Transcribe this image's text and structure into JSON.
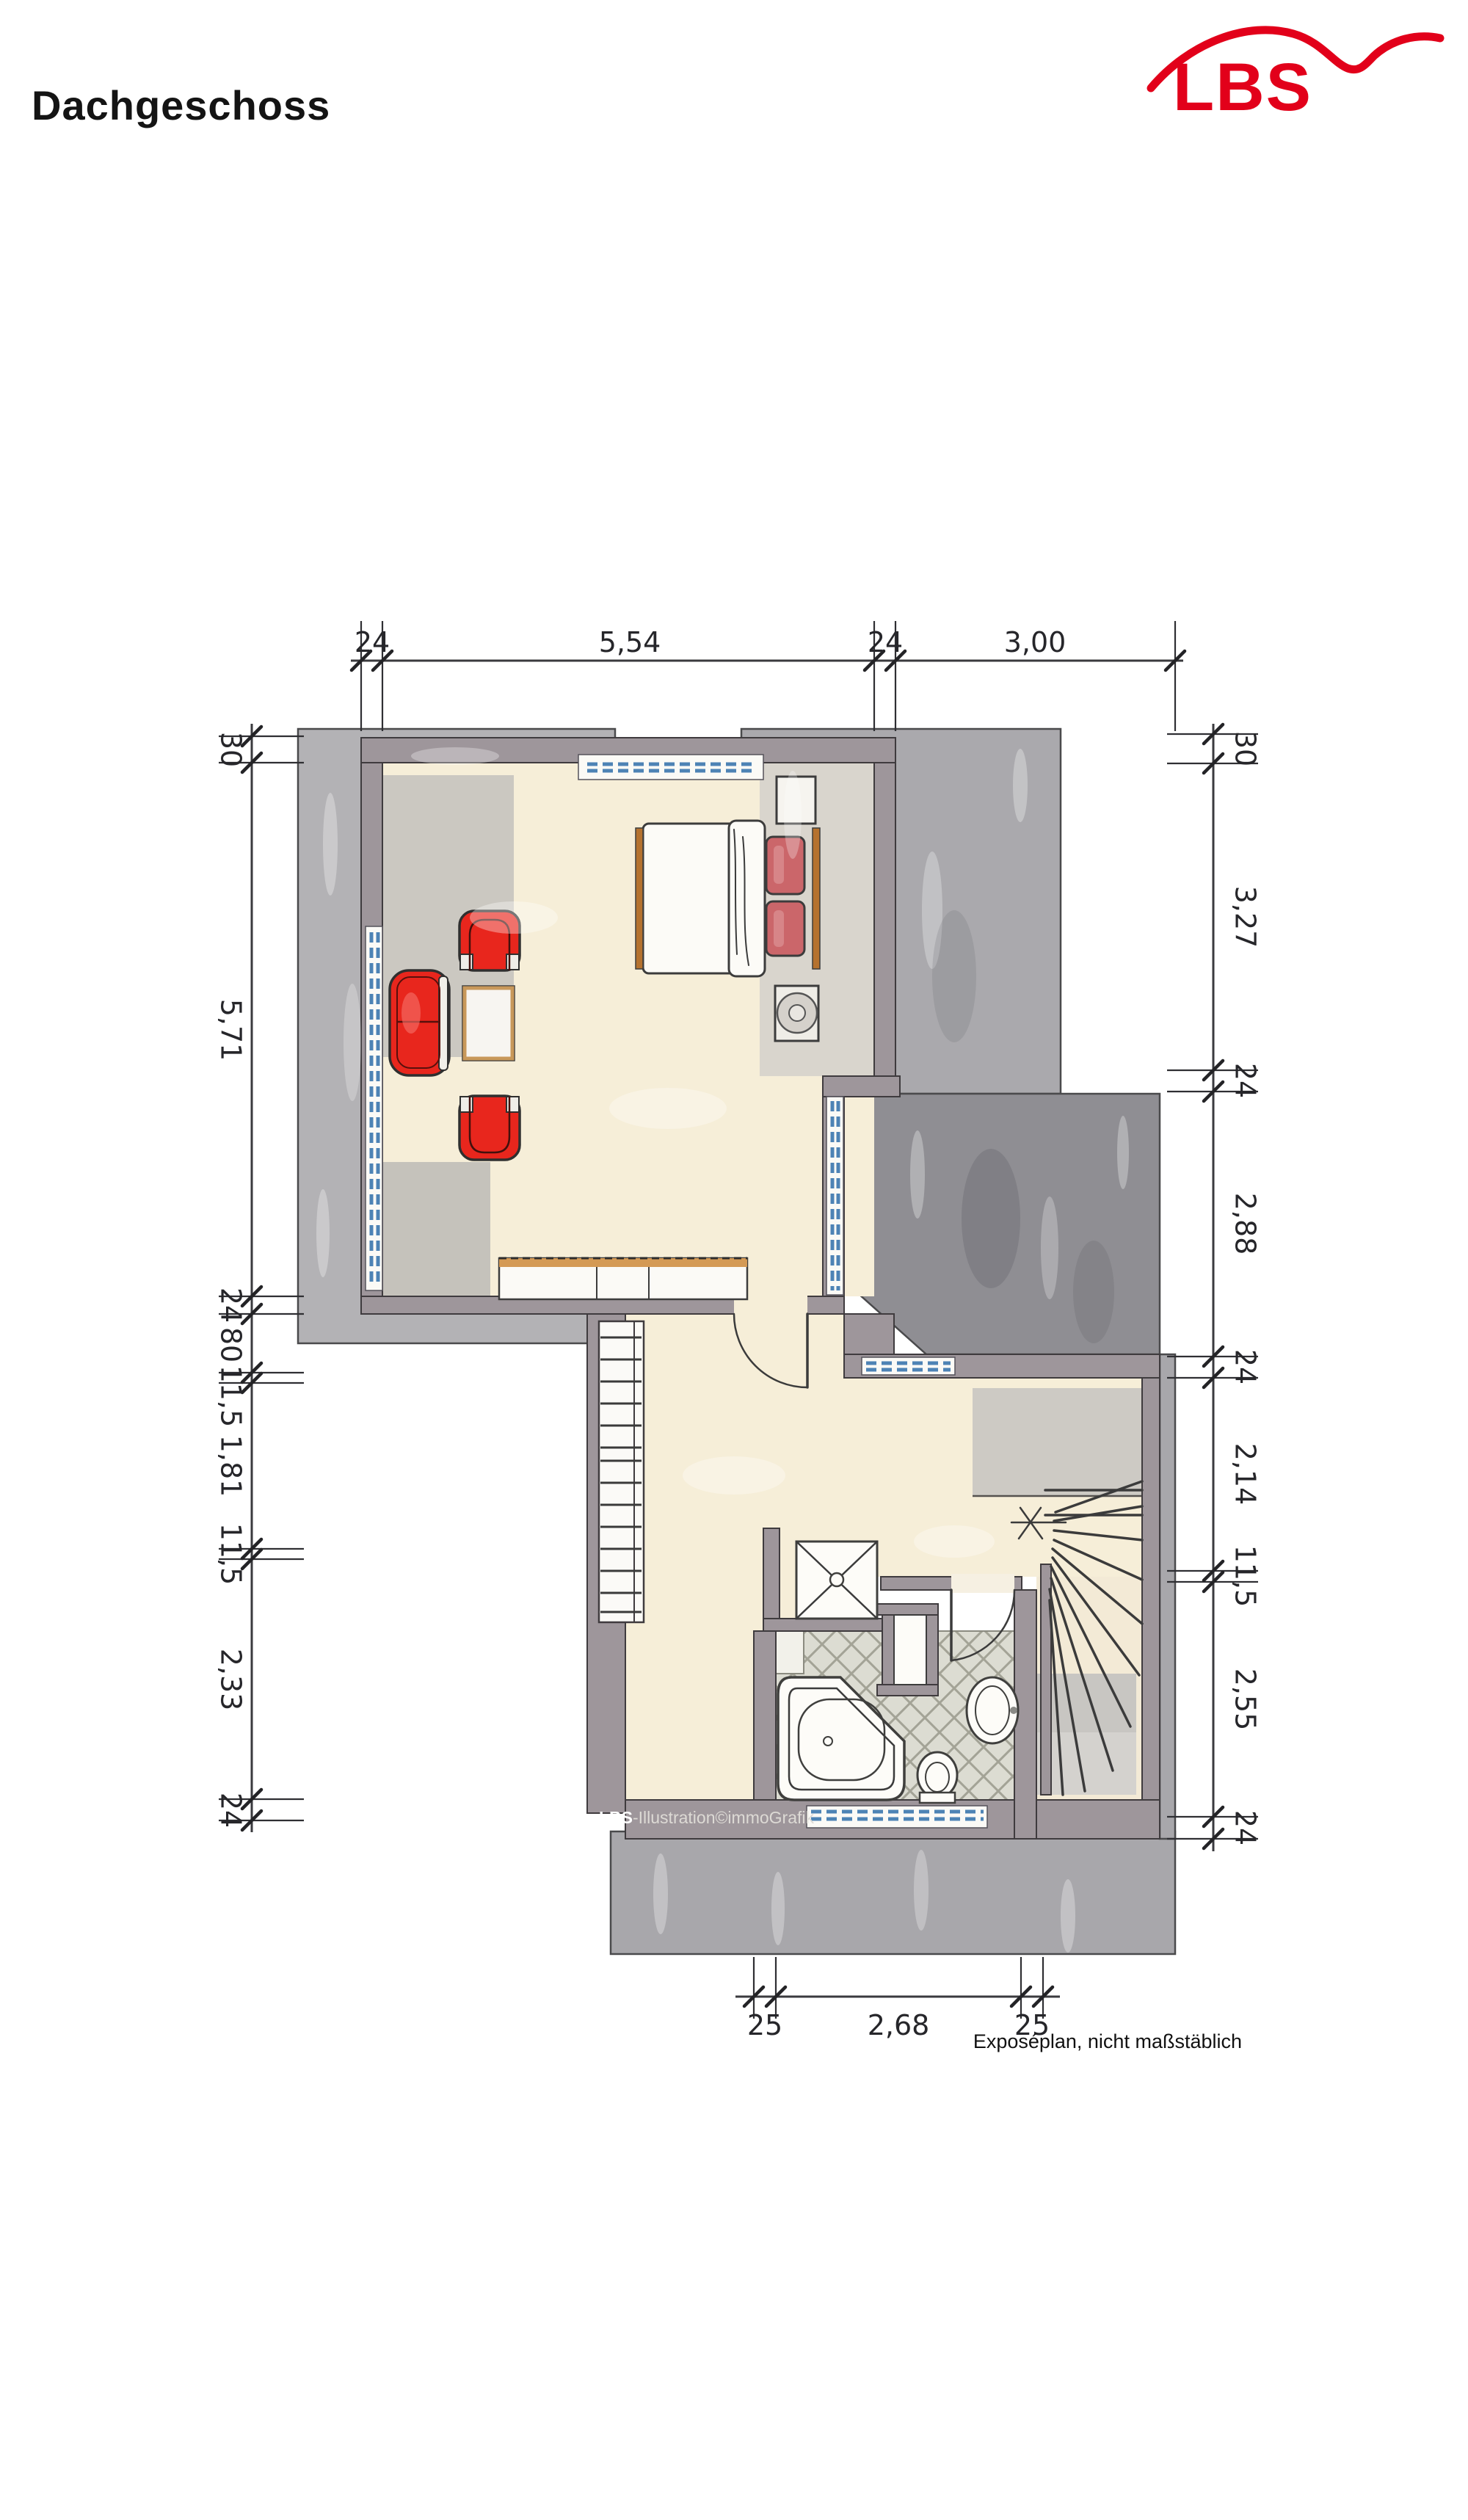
{
  "header": {
    "title": "Dachgeschoss"
  },
  "brand": {
    "name": "LBS",
    "color": "#e2001a"
  },
  "plan": {
    "watermark_bold": "LBS",
    "watermark_rest": "-Illustration©immoGrafik"
  },
  "footer": {
    "note": "Exposéplan, nicht maßstäblich"
  },
  "dimensions": {
    "top": [
      "24",
      "5,54",
      "24",
      "3,00"
    ],
    "left": [
      "30",
      "5,71",
      "24",
      "80",
      "11,5",
      "1,81",
      "11,5",
      "2,33",
      "24"
    ],
    "right": [
      "30",
      "3,27",
      "24",
      "2,88",
      "24",
      "2,14",
      "11,5",
      "2,55",
      "24"
    ],
    "bottom": [
      "25",
      "2,68",
      "25"
    ]
  },
  "colors": {
    "brand_red": "#e2001a",
    "floor_beige": "#f6eed8",
    "roof_gray": "#a8a7ab",
    "roof_gray_dark": "#8f8e93",
    "wall_mauve": "#9e969b",
    "window_blue": "#4d83b5",
    "furniture_red": "#e8261d",
    "pillow_red": "#cb666a",
    "wood_brown": "#b5722f",
    "tile_gray": "#dcdcd2"
  }
}
